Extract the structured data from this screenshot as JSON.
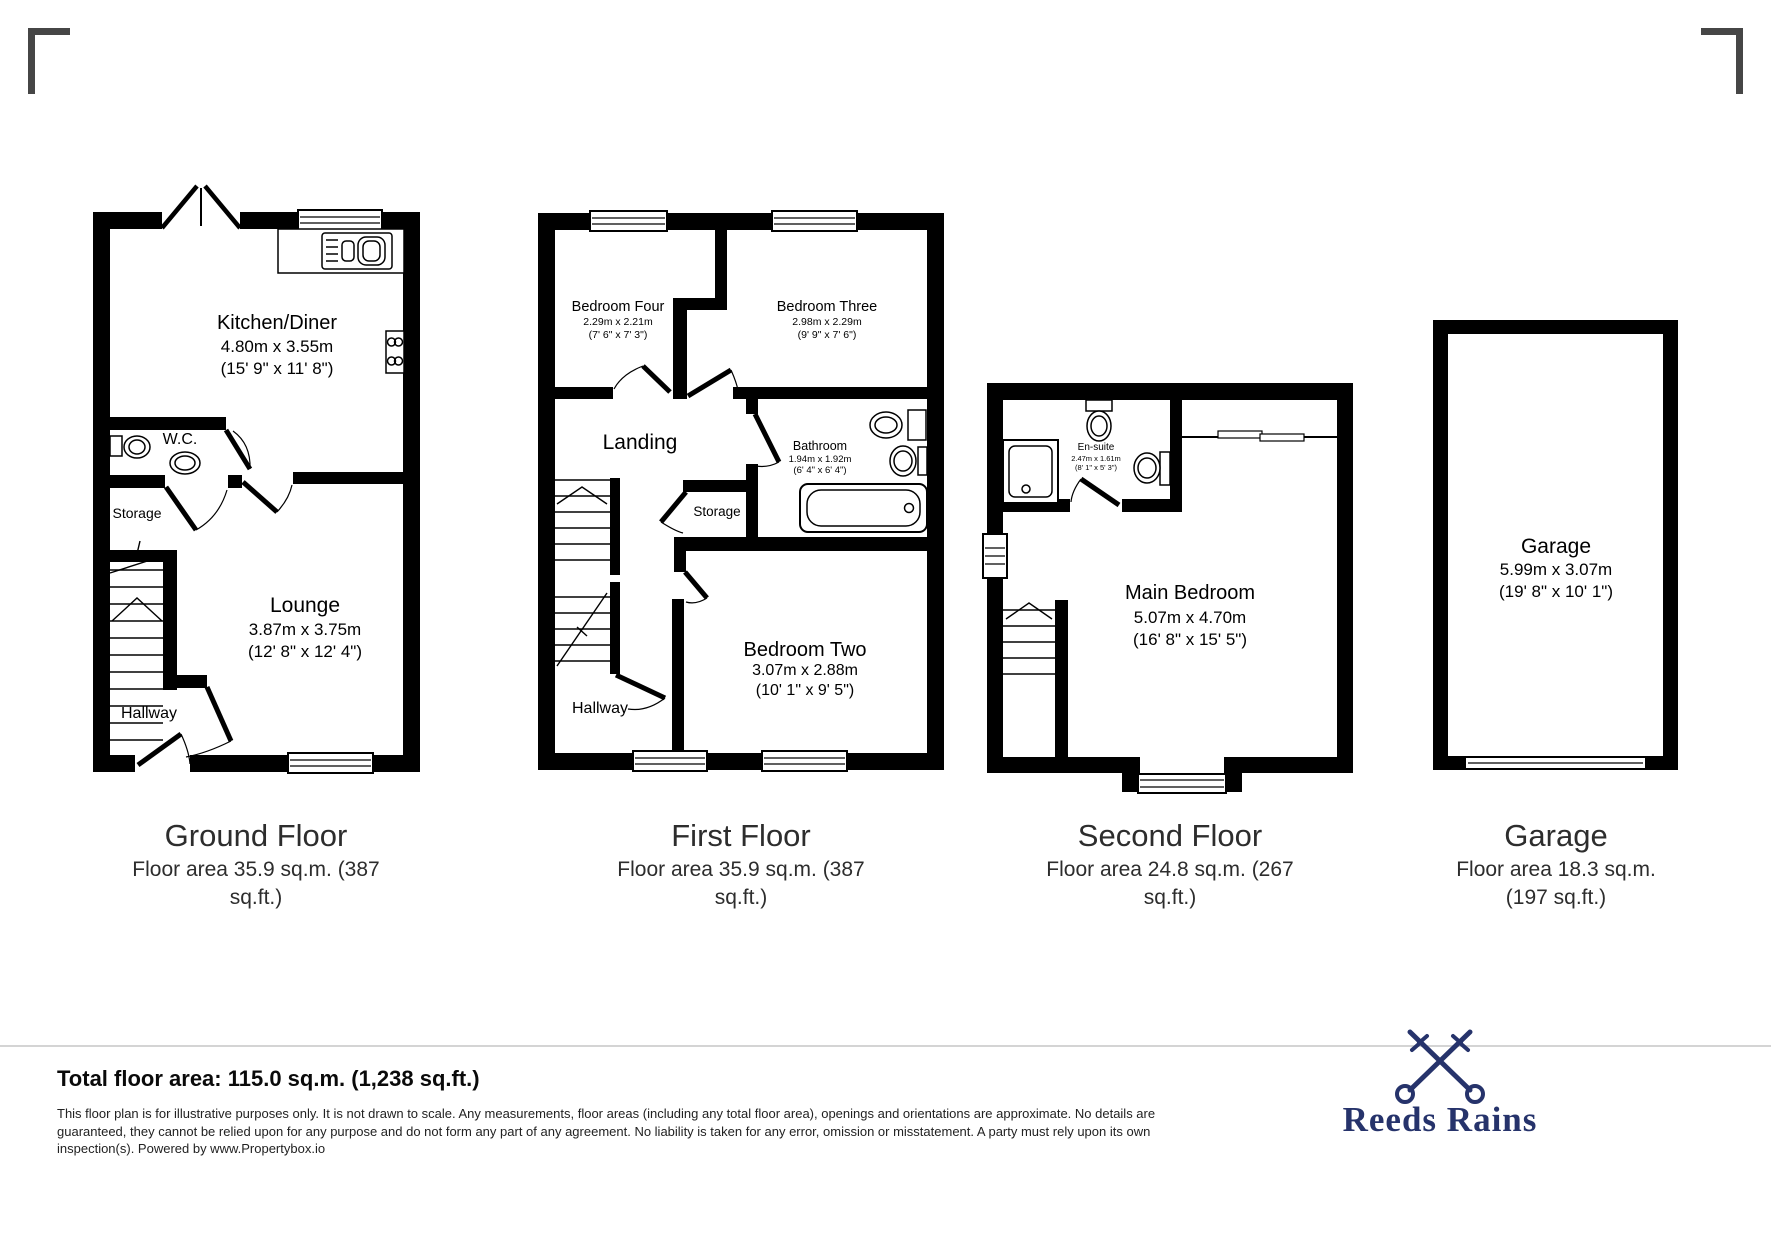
{
  "floors": {
    "ground": {
      "title": "Ground Floor",
      "area": [
        "Floor area 35.9 sq.m. (387",
        "sq.ft.)"
      ],
      "rooms": {
        "kitchen": {
          "name": "Kitchen/Diner",
          "metric": "4.80m x 3.55m",
          "imperial": "(15' 9\" x 11' 8\")"
        },
        "wc": {
          "name": "W.C."
        },
        "storage": {
          "name": "Storage"
        },
        "lounge": {
          "name": "Lounge",
          "metric": "3.87m x 3.75m",
          "imperial": "(12' 8\" x 12' 4\")"
        },
        "hallway": {
          "name": "Hallway"
        }
      }
    },
    "first": {
      "title": "First Floor",
      "area": [
        "Floor area 35.9 sq.m. (387",
        "sq.ft.)"
      ],
      "rooms": {
        "bedroom_four": {
          "name": "Bedroom Four",
          "metric": "2.29m x 2.21m",
          "imperial": "(7' 6\" x 7' 3\")"
        },
        "bedroom_three": {
          "name": "Bedroom Three",
          "metric": "2.98m x 2.29m",
          "imperial": "(9' 9\" x 7' 6\")"
        },
        "landing": {
          "name": "Landing"
        },
        "bathroom": {
          "name": "Bathroom",
          "metric": "1.94m x 1.92m",
          "imperial": "(6' 4\" x 6' 4\")"
        },
        "storage": {
          "name": "Storage"
        },
        "bedroom_two": {
          "name": "Bedroom Two",
          "metric": "3.07m x 2.88m",
          "imperial": "(10' 1\" x 9' 5\")"
        },
        "hallway": {
          "name": "Hallway"
        }
      }
    },
    "second": {
      "title": "Second Floor",
      "area": [
        "Floor area 24.8 sq.m. (267",
        "sq.ft.)"
      ],
      "rooms": {
        "ensuite": {
          "name": "En-suite",
          "metric": "2.47m x 1.61m",
          "imperial": "(8' 1\" x 5' 3\")"
        },
        "main_bedroom": {
          "name": "Main Bedroom",
          "metric": "5.07m x 4.70m",
          "imperial": "(16' 8\" x 15' 5\")"
        }
      }
    },
    "garage": {
      "title": "Garage",
      "area": [
        "Floor area 18.3 sq.m.",
        "(197 sq.ft.)"
      ],
      "rooms": {
        "garage": {
          "name": "Garage",
          "metric": "5.99m x 3.07m",
          "imperial": "(19' 8\" x 10' 1\")"
        }
      }
    }
  },
  "footer": {
    "total": "Total floor area: 115.0 sq.m. (1,238 sq.ft.)",
    "disclaimer": "This floor plan is for illustrative purposes only. It is not drawn to scale. Any measurements, floor areas (including any total floor area), openings and orientations are approximate. No details are guaranteed, they cannot be relied upon for any purpose and do not form any part of any agreement. No liability is taken for any error, omission or misstatement. A party must rely upon its own inspection(s). Powered by www.Propertybox.io",
    "brand": "Reeds Rains",
    "brand_icon": "crossed-keys",
    "accent_color": "#26336b"
  }
}
